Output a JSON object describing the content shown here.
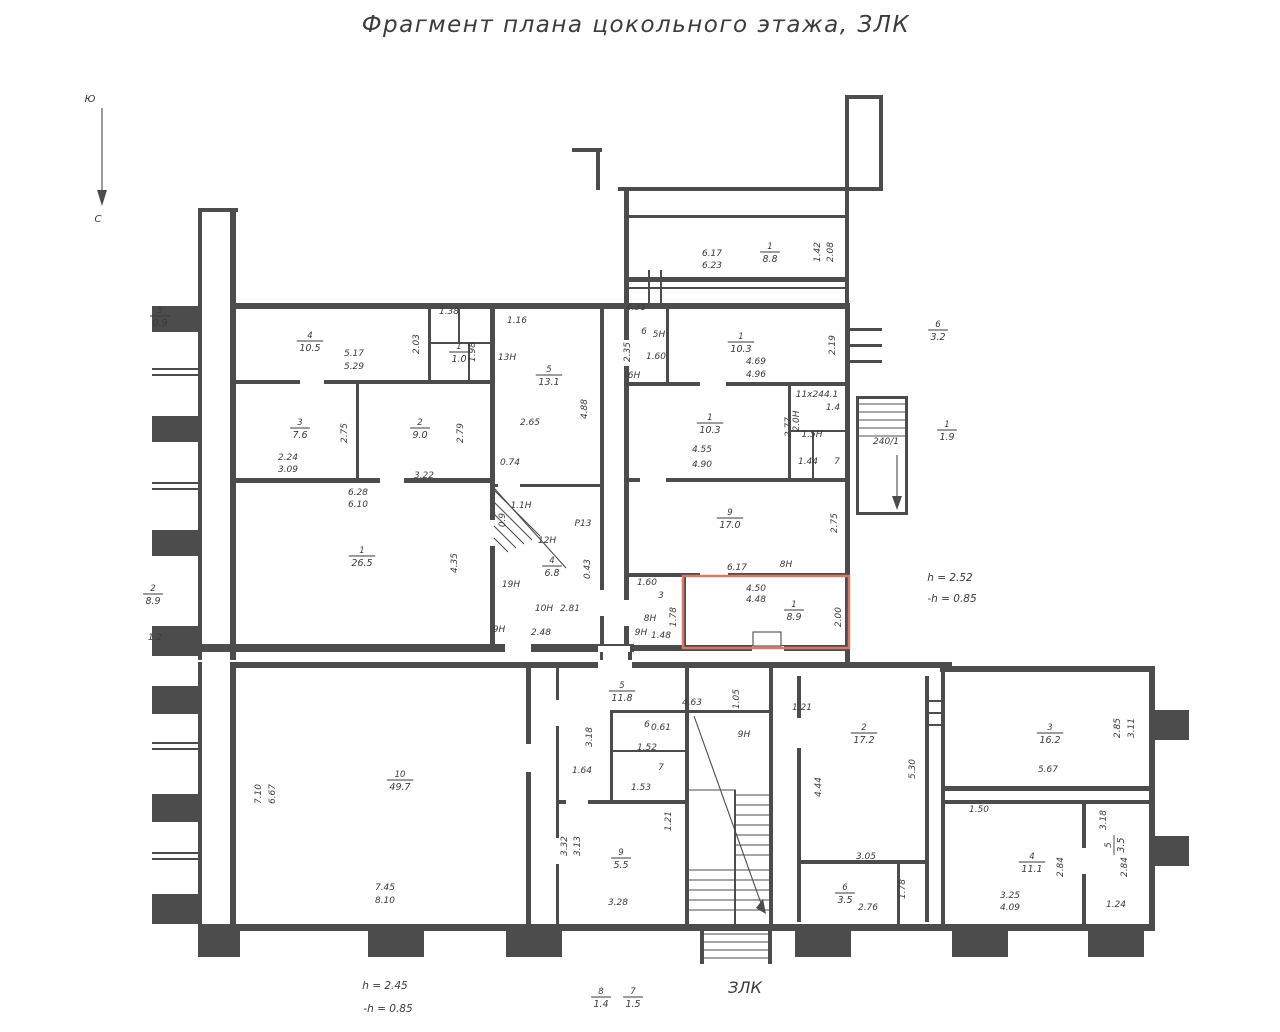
{
  "title": "Фрагмент плана  цокольного этажа, ЗЛК",
  "compass": {
    "top": "Ю",
    "bottom": "С"
  },
  "notes": {
    "right": [
      "h = 2.52",
      "-h = 0.85"
    ],
    "bottom": [
      "h = 2.45",
      "-h = 0.85"
    ]
  },
  "stair_label": "ЗЛК",
  "stair_tag": "240/1",
  "colors": {
    "wall": "#4c4c4c",
    "text": "#3a3a3a",
    "highlight": "#d9786d",
    "background": "#ffffff"
  },
  "highlighted_room": {
    "number": "1",
    "area": "8.9"
  },
  "rooms": [
    {
      "number": "1",
      "area": "8.8",
      "x": 770,
      "y": 252
    },
    {
      "number": "4",
      "area": "10.5",
      "x": 310,
      "y": 341
    },
    {
      "number": "1",
      "area": "1.0",
      "x": 459,
      "y": 352
    },
    {
      "number": "3",
      "area": "7.6",
      "x": 300,
      "y": 428
    },
    {
      "number": "2",
      "area": "9.0",
      "x": 420,
      "y": 428
    },
    {
      "number": "5",
      "area": "13.1",
      "x": 549,
      "y": 375
    },
    {
      "number": "1",
      "area": "26.5",
      "x": 362,
      "y": 556
    },
    {
      "number": "5",
      "area": "0.9",
      "x": 160,
      "y": 316
    },
    {
      "number": "2",
      "area": "8.9",
      "x": 153,
      "y": 594
    },
    {
      "number": "6",
      "area": "3.2",
      "x": 938,
      "y": 330
    },
    {
      "number": "1",
      "area": "1.9",
      "x": 947,
      "y": 430
    },
    {
      "number": "1",
      "area": "10.3",
      "x": 741,
      "y": 342
    },
    {
      "number": "1",
      "area": "10.3",
      "x": 710,
      "y": 423
    },
    {
      "number": "9",
      "area": "17.0",
      "x": 730,
      "y": 518
    },
    {
      "number": "1",
      "area": "8.9",
      "x": 794,
      "y": 610
    },
    {
      "number": "4",
      "area": "6.8",
      "x": 552,
      "y": 566
    },
    {
      "number": "10",
      "area": "49.7",
      "x": 400,
      "y": 780
    },
    {
      "number": "5",
      "area": "11.8",
      "x": 622,
      "y": 691
    },
    {
      "number": "2",
      "area": "17.2",
      "x": 864,
      "y": 733
    },
    {
      "number": "3",
      "area": "16.2",
      "x": 1050,
      "y": 733
    },
    {
      "number": "4",
      "area": "11.1",
      "x": 1032,
      "y": 862
    },
    {
      "number": "5",
      "area": "3.5",
      "x": 1114,
      "y": 845,
      "rot": -90
    },
    {
      "number": "6",
      "area": "3.5",
      "x": 845,
      "y": 893
    },
    {
      "number": "9",
      "area": "5.5",
      "x": 621,
      "y": 858
    },
    {
      "number": "8",
      "area": "1.4",
      "x": 601,
      "y": 997
    },
    {
      "number": "7",
      "area": "1.5",
      "x": 633,
      "y": 997
    }
  ],
  "dims": [
    {
      "t": "6.17",
      "x": 712,
      "y": 256
    },
    {
      "t": "6.23",
      "x": 712,
      "y": 268
    },
    {
      "t": "1.42",
      "x": 820,
      "y": 252,
      "r": 1,
      "s": 8
    },
    {
      "t": "2.08",
      "x": 833,
      "y": 252,
      "r": 1,
      "s": 8
    },
    {
      "t": "5.17",
      "x": 354,
      "y": 356
    },
    {
      "t": "5.29",
      "x": 354,
      "y": 369
    },
    {
      "t": "2.03",
      "x": 419,
      "y": 344,
      "r": 1
    },
    {
      "t": "1.38",
      "x": 449,
      "y": 314,
      "s": 7.5
    },
    {
      "t": "1.98",
      "x": 475,
      "y": 352,
      "r": 1,
      "s": 7.5
    },
    {
      "t": "1.16",
      "x": 517,
      "y": 323
    },
    {
      "t": "13Н",
      "x": 507,
      "y": 360,
      "s": 8.5
    },
    {
      "t": "2.65",
      "x": 530,
      "y": 425
    },
    {
      "t": "4.88",
      "x": 587,
      "y": 409,
      "r": 1
    },
    {
      "t": "0.74",
      "x": 510,
      "y": 465,
      "s": 8.5
    },
    {
      "t": "2.24",
      "x": 288,
      "y": 460
    },
    {
      "t": "3.09",
      "x": 288,
      "y": 472
    },
    {
      "t": "2.75",
      "x": 347,
      "y": 433,
      "r": 1
    },
    {
      "t": "3.22",
      "x": 424,
      "y": 478
    },
    {
      "t": "2.79",
      "x": 463,
      "y": 433,
      "r": 1
    },
    {
      "t": "6.28",
      "x": 358,
      "y": 495
    },
    {
      "t": "6.10",
      "x": 358,
      "y": 507
    },
    {
      "t": "4.35",
      "x": 457,
      "y": 563,
      "r": 1
    },
    {
      "t": "4.31",
      "x": 636,
      "y": 310,
      "s": 7.5
    },
    {
      "t": "6",
      "x": 644,
      "y": 334,
      "s": 8
    },
    {
      "t": "5Н",
      "x": 659,
      "y": 337,
      "s": 8
    },
    {
      "t": "2.35",
      "x": 630,
      "y": 352,
      "r": 1,
      "s": 7.5
    },
    {
      "t": "1.60",
      "x": 656,
      "y": 359,
      "s": 7.5
    },
    {
      "t": "6Н",
      "x": 634,
      "y": 378,
      "s": 7.5
    },
    {
      "t": "4.69",
      "x": 756,
      "y": 364
    },
    {
      "t": "4.96",
      "x": 756,
      "y": 377
    },
    {
      "t": "2.19",
      "x": 835,
      "y": 345,
      "r": 1,
      "s": 8
    },
    {
      "t": "11х244.1",
      "x": 817,
      "y": 397,
      "s": 6.5
    },
    {
      "t": "1.4",
      "x": 833,
      "y": 410,
      "s": 7
    },
    {
      "t": "2.0Н",
      "x": 799,
      "y": 421,
      "r": 1,
      "s": 7
    },
    {
      "t": "1.5Н",
      "x": 812,
      "y": 437,
      "s": 7
    },
    {
      "t": "1.44",
      "x": 808,
      "y": 464,
      "s": 7
    },
    {
      "t": "7",
      "x": 837,
      "y": 464,
      "s": 7
    },
    {
      "t": "2.77",
      "x": 791,
      "y": 427,
      "r": 1,
      "s": 8
    },
    {
      "t": "4.55",
      "x": 702,
      "y": 452
    },
    {
      "t": "4.90",
      "x": 702,
      "y": 467
    },
    {
      "t": "2.75",
      "x": 837,
      "y": 523,
      "r": 1
    },
    {
      "t": "6.17",
      "x": 737,
      "y": 570
    },
    {
      "t": "8Н",
      "x": 786,
      "y": 567,
      "s": 8
    },
    {
      "t": "1.60",
      "x": 647,
      "y": 585,
      "s": 7.5
    },
    {
      "t": "3",
      "x": 661,
      "y": 598,
      "s": 8
    },
    {
      "t": "8Н",
      "x": 650,
      "y": 621,
      "s": 7.5
    },
    {
      "t": "9Н",
      "x": 641,
      "y": 635,
      "s": 7
    },
    {
      "t": "1.48",
      "x": 661,
      "y": 638,
      "s": 7
    },
    {
      "t": "1.78",
      "x": 676,
      "y": 617,
      "r": 1,
      "s": 7
    },
    {
      "t": "4.50",
      "x": 756,
      "y": 591,
      "s": 8.5
    },
    {
      "t": "4.48",
      "x": 756,
      "y": 602,
      "s": 8.5
    },
    {
      "t": "2.00",
      "x": 841,
      "y": 617,
      "r": 1,
      "s": 8
    },
    {
      "t": "0.9",
      "x": 505,
      "y": 520,
      "r": 1,
      "s": 7.5
    },
    {
      "t": "1.1Н",
      "x": 521,
      "y": 508,
      "s": 7
    },
    {
      "t": "Р13",
      "x": 583,
      "y": 526,
      "s": 7.5
    },
    {
      "t": "12Н",
      "x": 547,
      "y": 543,
      "s": 8.5
    },
    {
      "t": "0.43",
      "x": 590,
      "y": 569,
      "r": 1,
      "s": 7.5
    },
    {
      "t": "19Н",
      "x": 511,
      "y": 587,
      "s": 8
    },
    {
      "t": "10Н",
      "x": 544,
      "y": 611,
      "s": 7.5
    },
    {
      "t": "2.81",
      "x": 570,
      "y": 611,
      "s": 7.5
    },
    {
      "t": "9Н",
      "x": 499,
      "y": 632,
      "s": 7
    },
    {
      "t": "2.48",
      "x": 541,
      "y": 635,
      "s": 7
    },
    {
      "t": "1.2",
      "x": 155,
      "y": 640
    },
    {
      "t": "7.10",
      "x": 261,
      "y": 794,
      "r": 1
    },
    {
      "t": "6.67",
      "x": 275,
      "y": 794,
      "r": 1
    },
    {
      "t": "7.45",
      "x": 385,
      "y": 890
    },
    {
      "t": "8.10",
      "x": 385,
      "y": 903
    },
    {
      "t": "3.18",
      "x": 592,
      "y": 737,
      "r": 1,
      "s": 8
    },
    {
      "t": "1.64",
      "x": 582,
      "y": 773,
      "s": 8.5
    },
    {
      "t": "4.63",
      "x": 692,
      "y": 705
    },
    {
      "t": "1.05",
      "x": 739,
      "y": 699,
      "r": 1,
      "s": 8
    },
    {
      "t": "9Н",
      "x": 744,
      "y": 737,
      "s": 8.5
    },
    {
      "t": "6",
      "x": 647,
      "y": 727,
      "s": 7
    },
    {
      "t": "0.61",
      "x": 661,
      "y": 730,
      "s": 6.5
    },
    {
      "t": "1.52",
      "x": 647,
      "y": 750,
      "s": 7
    },
    {
      "t": "7",
      "x": 661,
      "y": 770,
      "s": 7.5
    },
    {
      "t": "1.53",
      "x": 641,
      "y": 790,
      "s": 7
    },
    {
      "t": "1.21",
      "x": 671,
      "y": 821,
      "r": 1,
      "s": 7.5
    },
    {
      "t": "3.32",
      "x": 567,
      "y": 846,
      "r": 1,
      "s": 8
    },
    {
      "t": "3.13",
      "x": 580,
      "y": 846,
      "r": 1,
      "s": 8
    },
    {
      "t": "3.28",
      "x": 618,
      "y": 905
    },
    {
      "t": "1.21",
      "x": 802,
      "y": 710,
      "s": 8.5
    },
    {
      "t": "4.44",
      "x": 821,
      "y": 787,
      "r": 1
    },
    {
      "t": "5.30",
      "x": 915,
      "y": 769,
      "r": 1
    },
    {
      "t": "3.05",
      "x": 866,
      "y": 859,
      "s": 8.5
    },
    {
      "t": "2.76",
      "x": 868,
      "y": 910
    },
    {
      "t": "1.78",
      "x": 905,
      "y": 889,
      "r": 1,
      "s": 8
    },
    {
      "t": "2.85",
      "x": 1120,
      "y": 728,
      "r": 1,
      "s": 8
    },
    {
      "t": "3.11",
      "x": 1134,
      "y": 728,
      "r": 1,
      "s": 8
    },
    {
      "t": "5.67",
      "x": 1048,
      "y": 772
    },
    {
      "t": "1.50",
      "x": 979,
      "y": 812,
      "s": 8.5
    },
    {
      "t": "2.84",
      "x": 1063,
      "y": 867,
      "r": 1,
      "s": 8
    },
    {
      "t": "2.84",
      "x": 1127,
      "y": 867,
      "r": 1,
      "s": 8
    },
    {
      "t": "3.25",
      "x": 1010,
      "y": 898
    },
    {
      "t": "4.09",
      "x": 1010,
      "y": 910
    },
    {
      "t": "3.18",
      "x": 1106,
      "y": 820,
      "r": 1,
      "s": 7.5
    },
    {
      "t": "1.24",
      "x": 1116,
      "y": 907,
      "s": 8.5
    },
    {
      "t": "240/1",
      "x": 886,
      "y": 444,
      "s": 7.5
    }
  ]
}
